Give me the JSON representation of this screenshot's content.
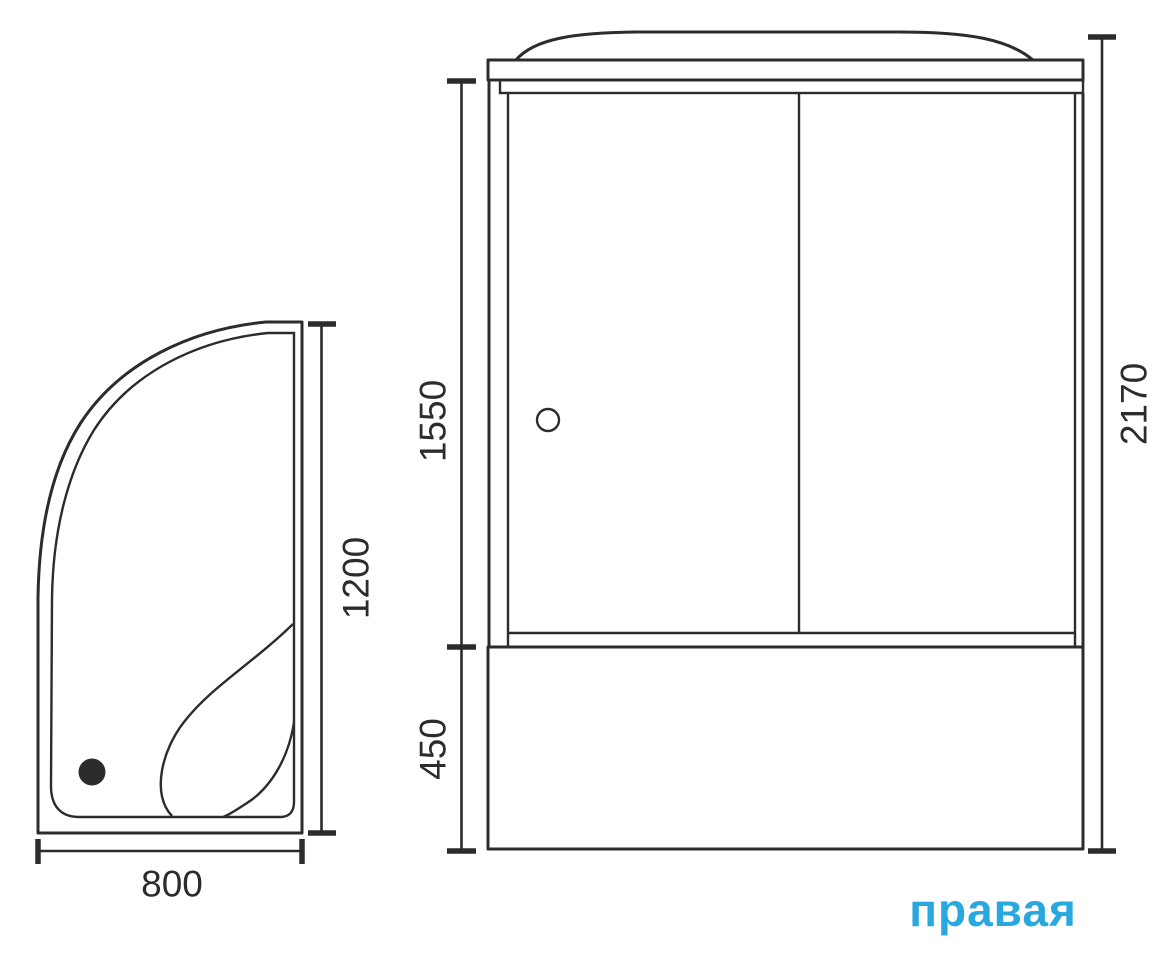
{
  "drawing": {
    "line_color": "#2c2c2c",
    "accent_color": "#29a8e0",
    "orientation_label": "правая",
    "front_view": {
      "door_height_mm": "1550",
      "base_height_mm": "450",
      "total_height_mm": "2170"
    },
    "plan_view": {
      "width_mm": "800",
      "depth_mm": "1200"
    }
  }
}
